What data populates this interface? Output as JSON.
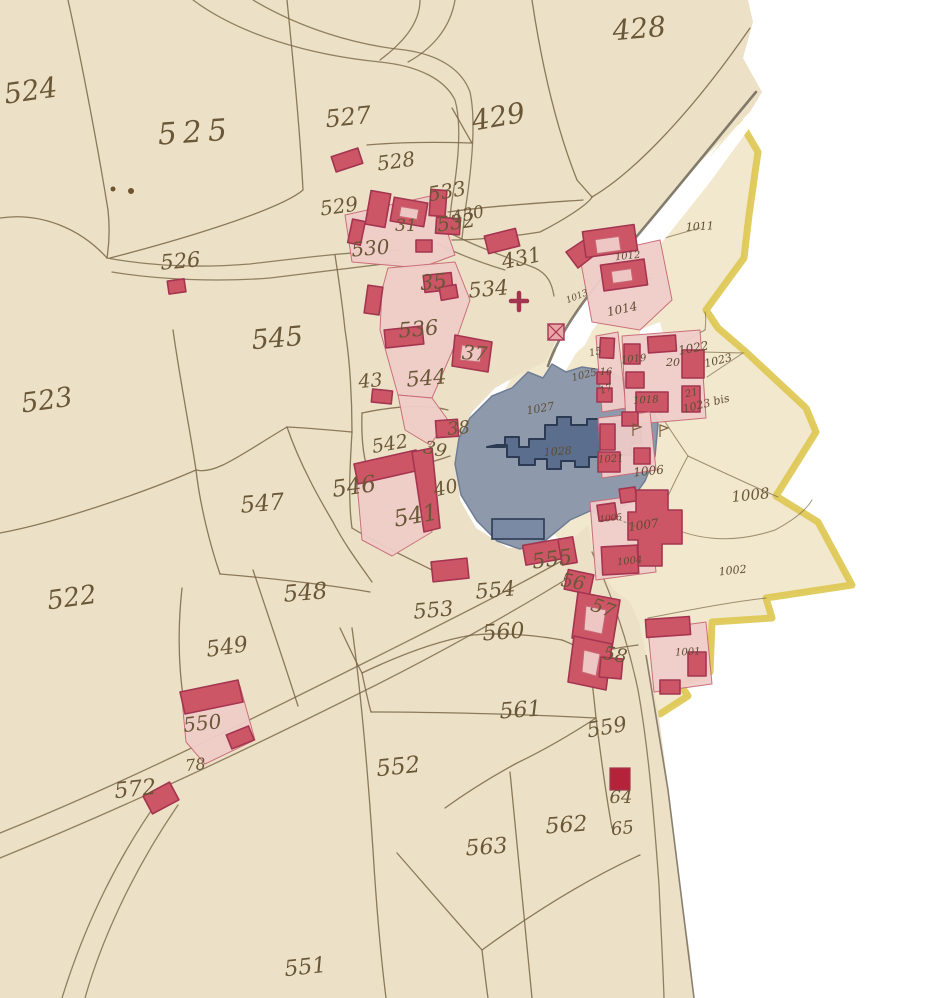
{
  "map": {
    "description": "Hand-drawn cadastral map: two joined manuscript sheets, beige paper, sepia parcel lines, red buildings with pink courtyards, a blue-grey pond with a dark-blue crenellated building, yellow commune boundary on the right sheet, white torn gaps between sheets",
    "sheets": [
      {
        "name": "left-sheet",
        "parcel_series": "400s-500s"
      },
      {
        "name": "right-sheet",
        "parcel_series": "1000s",
        "boundary": "yellow"
      }
    ],
    "palette": {
      "paper_left": "#ece1c6",
      "paper_right": "#f1e8cd",
      "line_ink": "#7a6647",
      "building_fill": "#cd5666",
      "building_stroke": "#a43550",
      "building_solid": "#b5233a",
      "courtyard_fill": "#f0cdc9",
      "courtyard_stroke": "#c86a76",
      "pond_fill": "#8e9aac",
      "pond_building_fill": "#5c6e8e",
      "pond_building_stroke": "#2c3a54",
      "boundary_yellow": "#ddc64f",
      "label_ink": "#6a5737",
      "label_ink_right": "#5d4c33",
      "pond_ink": "#2e3448"
    },
    "symbols": [
      {
        "name": "church-cross",
        "x": 519,
        "y": 301
      },
      {
        "name": "hatched-square",
        "x": 548,
        "y": 324
      },
      {
        "name": "flag-marker",
        "x": 633,
        "y": 430
      },
      {
        "name": "flag-marker",
        "x": 660,
        "y": 431
      }
    ],
    "labels": [
      {
        "t": "524",
        "x": 32,
        "y": 100,
        "s": 28,
        "r": -8
      },
      {
        "t": "525",
        "x": 196,
        "y": 142,
        "s": 30,
        "r": -4,
        "sp": 6
      },
      {
        "t": "527",
        "x": 349,
        "y": 125,
        "s": 24,
        "r": -6
      },
      {
        "t": "428",
        "x": 640,
        "y": 38,
        "s": 28,
        "r": -5
      },
      {
        "t": "429",
        "x": 500,
        "y": 126,
        "s": 28,
        "r": -10
      },
      {
        "t": "528",
        "x": 397,
        "y": 168,
        "s": 20,
        "r": -8
      },
      {
        "t": "529",
        "x": 340,
        "y": 213,
        "s": 20,
        "r": -8
      },
      {
        "t": "533",
        "x": 448,
        "y": 198,
        "s": 20,
        "r": -10
      },
      {
        "t": "31",
        "x": 406,
        "y": 231,
        "s": 17,
        "r": 0
      },
      {
        "t": "532",
        "x": 457,
        "y": 229,
        "s": 20,
        "r": -8
      },
      {
        "t": "530",
        "x": 371,
        "y": 255,
        "s": 20,
        "r": -5
      },
      {
        "t": "430",
        "x": 469,
        "y": 220,
        "s": 17,
        "r": -12
      },
      {
        "t": "526",
        "x": 181,
        "y": 268,
        "s": 21,
        "r": -5
      },
      {
        "t": "431",
        "x": 523,
        "y": 265,
        "s": 21,
        "r": -12
      },
      {
        "t": "35",
        "x": 434,
        "y": 289,
        "s": 21,
        "r": -5
      },
      {
        "t": "534",
        "x": 489,
        "y": 296,
        "s": 21,
        "r": -5
      },
      {
        "t": "536",
        "x": 419,
        "y": 336,
        "s": 21,
        "r": -5
      },
      {
        "t": "545",
        "x": 278,
        "y": 347,
        "s": 27,
        "r": -5
      },
      {
        "t": "523",
        "x": 48,
        "y": 409,
        "s": 27,
        "r": -8
      },
      {
        "t": "43",
        "x": 371,
        "y": 387,
        "s": 19,
        "r": -5
      },
      {
        "t": "544",
        "x": 427,
        "y": 385,
        "s": 21,
        "r": -5
      },
      {
        "t": "37",
        "x": 474,
        "y": 360,
        "s": 20,
        "r": 5
      },
      {
        "t": "542",
        "x": 391,
        "y": 450,
        "s": 19,
        "r": -10
      },
      {
        "t": "38",
        "x": 459,
        "y": 434,
        "s": 18,
        "r": -5
      },
      {
        "t": "39",
        "x": 434,
        "y": 455,
        "s": 18,
        "r": 12
      },
      {
        "t": "546",
        "x": 355,
        "y": 494,
        "s": 23,
        "r": -8
      },
      {
        "t": "40",
        "x": 447,
        "y": 494,
        "s": 19,
        "r": -12
      },
      {
        "t": "547",
        "x": 263,
        "y": 511,
        "s": 23,
        "r": -5
      },
      {
        "t": "541",
        "x": 417,
        "y": 523,
        "s": 23,
        "r": -10
      },
      {
        "t": "548",
        "x": 306,
        "y": 600,
        "s": 23,
        "r": -5
      },
      {
        "t": "522",
        "x": 73,
        "y": 606,
        "s": 26,
        "r": -8
      },
      {
        "t": "549",
        "x": 228,
        "y": 654,
        "s": 22,
        "r": -8
      },
      {
        "t": "553",
        "x": 434,
        "y": 617,
        "s": 21,
        "r": -5
      },
      {
        "t": "554",
        "x": 496,
        "y": 597,
        "s": 21,
        "r": -5
      },
      {
        "t": "555",
        "x": 553,
        "y": 566,
        "s": 21,
        "r": -8
      },
      {
        "t": "56",
        "x": 572,
        "y": 588,
        "s": 19,
        "r": 10
      },
      {
        "t": "57",
        "x": 601,
        "y": 614,
        "s": 19,
        "r": 20
      },
      {
        "t": "560",
        "x": 504,
        "y": 639,
        "s": 22,
        "r": -4
      },
      {
        "t": "550",
        "x": 203,
        "y": 730,
        "s": 20,
        "r": -6
      },
      {
        "t": "78",
        "x": 196,
        "y": 770,
        "s": 16,
        "r": -6
      },
      {
        "t": "572",
        "x": 136,
        "y": 796,
        "s": 22,
        "r": -6
      },
      {
        "t": "561",
        "x": 521,
        "y": 717,
        "s": 22,
        "r": -4
      },
      {
        "t": "559",
        "x": 608,
        "y": 734,
        "s": 21,
        "r": -10
      },
      {
        "t": "58",
        "x": 614,
        "y": 661,
        "s": 19,
        "r": 10
      },
      {
        "t": "562",
        "x": 567,
        "y": 832,
        "s": 22,
        "r": -4
      },
      {
        "t": "563",
        "x": 487,
        "y": 854,
        "s": 22,
        "r": -4
      },
      {
        "t": "64",
        "x": 621,
        "y": 803,
        "s": 18,
        "r": 0
      },
      {
        "t": "65",
        "x": 623,
        "y": 834,
        "s": 18,
        "r": -6
      },
      {
        "t": "552",
        "x": 399,
        "y": 774,
        "s": 23,
        "r": -6
      },
      {
        "t": "551",
        "x": 306,
        "y": 974,
        "s": 22,
        "r": -6
      },
      {
        "t": "1011",
        "x": 700,
        "y": 230,
        "s": 11,
        "r": -3
      },
      {
        "t": "1012",
        "x": 628,
        "y": 259,
        "s": 10,
        "r": -6
      },
      {
        "t": "1013",
        "x": 578,
        "y": 299,
        "s": 9,
        "r": -22
      },
      {
        "t": "1014",
        "x": 623,
        "y": 313,
        "s": 12,
        "r": -12
      },
      {
        "t": "1022",
        "x": 694,
        "y": 352,
        "s": 12,
        "r": -10
      },
      {
        "t": "1023",
        "x": 719,
        "y": 364,
        "s": 11,
        "r": -14
      },
      {
        "t": "1023 bis",
        "x": 707,
        "y": 407,
        "s": 11,
        "r": -14
      },
      {
        "t": "15",
        "x": 596,
        "y": 355,
        "s": 10,
        "r": -12
      },
      {
        "t": "1025",
        "x": 585,
        "y": 378,
        "s": 10,
        "r": -14
      },
      {
        "t": "16",
        "x": 606,
        "y": 375,
        "s": 10,
        "r": 0
      },
      {
        "t": "17",
        "x": 607,
        "y": 392,
        "s": 10,
        "r": -20
      },
      {
        "t": "1019",
        "x": 634,
        "y": 362,
        "s": 10,
        "r": -6
      },
      {
        "t": "20",
        "x": 673,
        "y": 366,
        "s": 11,
        "r": 0
      },
      {
        "t": "1018",
        "x": 646,
        "y": 403,
        "s": 10,
        "r": -3
      },
      {
        "t": "21",
        "x": 692,
        "y": 396,
        "s": 10,
        "r": -12
      },
      {
        "t": "1021",
        "x": 611,
        "y": 462,
        "s": 10,
        "r": -3
      },
      {
        "t": "1006",
        "x": 649,
        "y": 475,
        "s": 12,
        "r": -6
      },
      {
        "t": "1008",
        "x": 751,
        "y": 500,
        "s": 15,
        "r": -6
      },
      {
        "t": "1005",
        "x": 611,
        "y": 521,
        "s": 9,
        "r": -6
      },
      {
        "t": "1007",
        "x": 644,
        "y": 529,
        "s": 12,
        "r": -8
      },
      {
        "t": "1004",
        "x": 630,
        "y": 564,
        "s": 10,
        "r": -6
      },
      {
        "t": "1002",
        "x": 733,
        "y": 574,
        "s": 11,
        "r": -6
      },
      {
        "t": "1001",
        "x": 688,
        "y": 655,
        "s": 10,
        "r": -3
      },
      {
        "t": "1027",
        "x": 541,
        "y": 412,
        "s": 11,
        "r": -10
      },
      {
        "t": "1028",
        "x": 558,
        "y": 455,
        "s": 11,
        "r": -4,
        "c": "pond_ink"
      }
    ]
  }
}
